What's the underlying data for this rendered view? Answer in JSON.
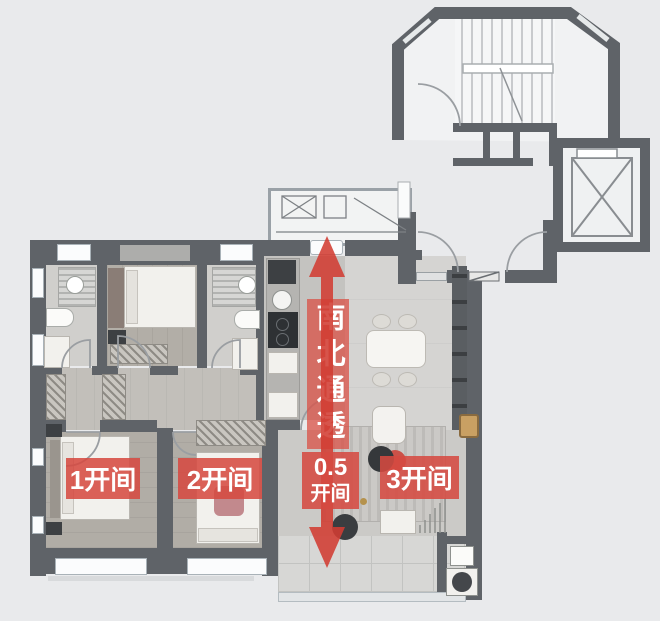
{
  "colors": {
    "accent_red": "#d9473d",
    "wall_gray": "#5f6368"
  },
  "labels": {
    "ns_banner": "南北通透",
    "bay_1": "1开间",
    "bay_2": "2开间",
    "bay_05_line1": "0.5",
    "bay_05_line2": "开间",
    "bay_3": "3开间"
  }
}
